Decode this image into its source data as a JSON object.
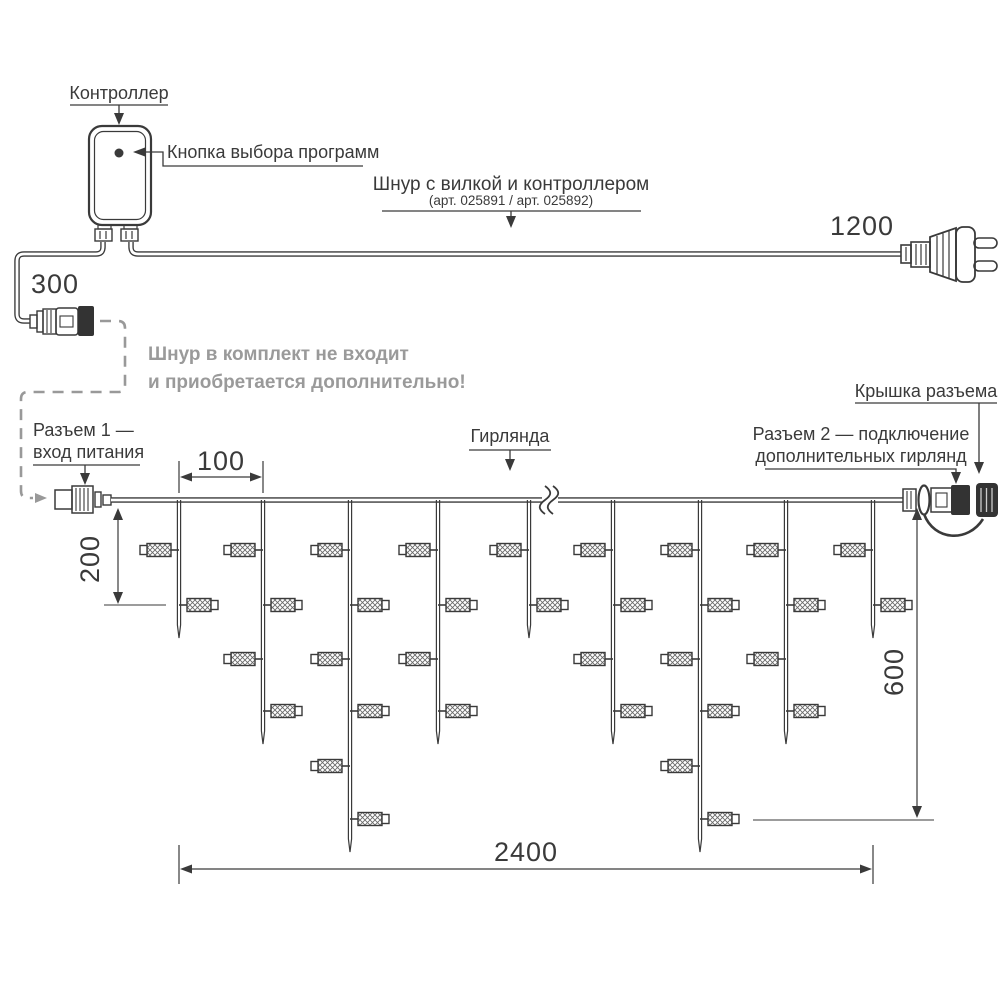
{
  "labels": {
    "controller": "Контроллер",
    "program_button": "Кнопка выбора программ",
    "cord_title": "Шнур с вилкой и контроллером",
    "cord_sku": "(арт. 025891 / арт. 025892)",
    "note_line1": "Шнур в комплект не входит",
    "note_line2": "и приобретается дополнительно!",
    "connector1_line1": "Разъем 1 —",
    "connector1_line2": "вход питания",
    "garland": "Гирлянда",
    "connector2_line1": "Разъем 2 — подключение",
    "connector2_line2": "дополнительных гирлянд",
    "connector_cap": "Крышка разъема"
  },
  "dimensions": {
    "controller_cord": "300",
    "plug_cord": "1200",
    "drop_spacing": "100",
    "short_drop": "200",
    "long_drop": "600",
    "total_length": "2400"
  },
  "colors": {
    "line": "#3a3a3a",
    "dark_fill": "#333333",
    "note_gray": "#9a9a9a",
    "dash_gray": "#999999"
  },
  "garland": {
    "wire_y": 500,
    "bulb_y": [
      550,
      605,
      659,
      711,
      766,
      819
    ],
    "break_x": 550,
    "drops": [
      {
        "x": 179,
        "bulbs": 2
      },
      {
        "x": 263,
        "bulbs": 4
      },
      {
        "x": 350,
        "bulbs": 6
      },
      {
        "x": 438,
        "bulbs": 4
      },
      {
        "x": 529,
        "bulbs": 2
      },
      {
        "x": 613,
        "bulbs": 4
      },
      {
        "x": 700,
        "bulbs": 6
      },
      {
        "x": 786,
        "bulbs": 4
      },
      {
        "x": 873,
        "bulbs": 2
      }
    ]
  }
}
